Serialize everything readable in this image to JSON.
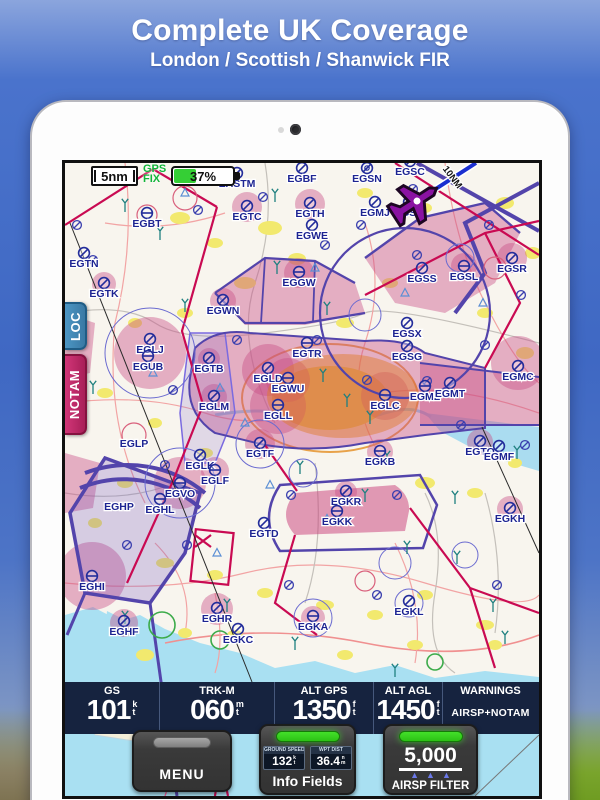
{
  "banner": {
    "title": "Complete UK Coverage",
    "subtitle": "London / Scottish / Shanwick FIR"
  },
  "hud": {
    "scale_label": "5nm",
    "gps_fix_line1": "GPS",
    "gps_fix_line2": "FIX",
    "battery_percent": 37,
    "battery_label": "37%",
    "track_distance_label": "10NM"
  },
  "side_tabs": {
    "loc": "LOC",
    "notam": "NOTAM"
  },
  "info_bar": {
    "cells": [
      {
        "label": "GS",
        "value": "101",
        "unit": [
          "k",
          "t"
        ]
      },
      {
        "label": "TRK-M",
        "value": "060",
        "unit": [
          "m",
          "t"
        ]
      },
      {
        "label": "ALT GPS",
        "value": "1350",
        "unit": [
          "f",
          "t"
        ]
      },
      {
        "label": "ALT AGL",
        "value": "1450",
        "unit": [
          "f",
          "t"
        ]
      },
      {
        "label": "WARNINGS",
        "value": "AIRSP+NOTAM"
      }
    ]
  },
  "bottom_buttons": {
    "menu_label": "MENU",
    "info_fields_label": "Info Fields",
    "mini_displays": [
      {
        "label": "GROUND SPEED",
        "value": "132",
        "unit": [
          "k",
          "t"
        ]
      },
      {
        "label": "WPT DIST",
        "value": "36.4",
        "unit": [
          "n",
          "m"
        ]
      }
    ],
    "airspace_filter_value": "5,000",
    "airspace_filter_label": "AIRSP FILTER"
  },
  "colors": {
    "accent_green": "#35cf35",
    "notam_pink": "#c42e6b",
    "loc_blue": "#4486b0",
    "infobar_navy": "#16233f",
    "aircraft_purple": "#8a12a2"
  },
  "map": {
    "airports": [
      {
        "id": "EASTM",
        "x": 172,
        "y": 24,
        "t": "s"
      },
      {
        "id": "EGBF",
        "x": 237,
        "y": 19,
        "t": "s"
      },
      {
        "id": "EGSN",
        "x": 302,
        "y": 19,
        "t": "d"
      },
      {
        "id": "EGSC",
        "x": 345,
        "y": 12,
        "t": "s"
      },
      {
        "id": "EGMJ",
        "x": 310,
        "y": 53,
        "t": "s"
      },
      {
        "id": "EGSU",
        "x": 344,
        "y": 53,
        "t": "s"
      },
      {
        "id": "EGBT",
        "x": 82,
        "y": 64,
        "t": "b"
      },
      {
        "id": "EGTC",
        "x": 182,
        "y": 57,
        "t": "s"
      },
      {
        "id": "EGTH",
        "x": 245,
        "y": 54,
        "t": "s"
      },
      {
        "id": "EGWE",
        "x": 247,
        "y": 76,
        "t": "s"
      },
      {
        "id": "EGTN",
        "x": 19,
        "y": 104,
        "t": "s"
      },
      {
        "id": "EGGW",
        "x": 234,
        "y": 123,
        "t": "b"
      },
      {
        "id": "EGSS",
        "x": 357,
        "y": 119,
        "t": "s"
      },
      {
        "id": "EGSL",
        "x": 399,
        "y": 117,
        "t": "b"
      },
      {
        "id": "EGSR",
        "x": 447,
        "y": 109,
        "t": "s"
      },
      {
        "id": "EGTK",
        "x": 39,
        "y": 134,
        "t": "s"
      },
      {
        "id": "EGWN",
        "x": 158,
        "y": 151,
        "t": "s"
      },
      {
        "id": "EGSX",
        "x": 342,
        "y": 174,
        "t": "s"
      },
      {
        "id": "EGSG",
        "x": 342,
        "y": 197,
        "t": "s"
      },
      {
        "id": "EGLJ",
        "x": 85,
        "y": 190,
        "t": "s"
      },
      {
        "id": "EGUB",
        "x": 83,
        "y": 207,
        "t": "b"
      },
      {
        "id": "EGTB",
        "x": 144,
        "y": 209,
        "t": "s"
      },
      {
        "id": "EGTR",
        "x": 242,
        "y": 194,
        "t": "b"
      },
      {
        "id": "EGLD",
        "x": 203,
        "y": 219,
        "t": "s"
      },
      {
        "id": "EGWU",
        "x": 223,
        "y": 229,
        "t": "b"
      },
      {
        "id": "EGMC",
        "x": 453,
        "y": 217,
        "t": "s"
      },
      {
        "id": "EGML",
        "x": 360,
        "y": 237,
        "t": "b"
      },
      {
        "id": "EGMT",
        "x": 385,
        "y": 234,
        "t": "s"
      },
      {
        "id": "EGLC",
        "x": 320,
        "y": 246,
        "t": "b"
      },
      {
        "id": "EGLM",
        "x": 149,
        "y": 247,
        "t": "s"
      },
      {
        "id": "EGLL",
        "x": 213,
        "y": 256,
        "t": "b"
      },
      {
        "id": "EGLP",
        "x": 69,
        "y": 284,
        "t": "n"
      },
      {
        "id": "EGTF",
        "x": 195,
        "y": 294,
        "t": "s"
      },
      {
        "id": "EGLK",
        "x": 135,
        "y": 306,
        "t": "s"
      },
      {
        "id": "EGLF",
        "x": 150,
        "y": 321,
        "t": "b"
      },
      {
        "id": "EGKB",
        "x": 315,
        "y": 302,
        "t": "b"
      },
      {
        "id": "EGTO",
        "x": 415,
        "y": 292,
        "t": "s"
      },
      {
        "id": "EGMF",
        "x": 434,
        "y": 297,
        "t": "s"
      },
      {
        "id": "EGVO",
        "x": 115,
        "y": 334,
        "t": "b"
      },
      {
        "id": "EGHP",
        "x": 54,
        "y": 347,
        "t": "n"
      },
      {
        "id": "EGHL",
        "x": 95,
        "y": 350,
        "t": "b"
      },
      {
        "id": "EGKR",
        "x": 281,
        "y": 342,
        "t": "s"
      },
      {
        "id": "EGKK",
        "x": 272,
        "y": 362,
        "t": "b"
      },
      {
        "id": "EGKH",
        "x": 445,
        "y": 359,
        "t": "s"
      },
      {
        "id": "EGTD",
        "x": 199,
        "y": 374,
        "t": "s"
      },
      {
        "id": "EGHI",
        "x": 27,
        "y": 427,
        "t": "b"
      },
      {
        "id": "EGHR",
        "x": 152,
        "y": 459,
        "t": "s"
      },
      {
        "id": "EGKL",
        "x": 344,
        "y": 452,
        "t": "s"
      },
      {
        "id": "EGKA",
        "x": 248,
        "y": 467,
        "t": "b"
      },
      {
        "id": "EGHF",
        "x": 59,
        "y": 472,
        "t": "s"
      },
      {
        "id": "EGKC",
        "x": 173,
        "y": 480,
        "t": "s"
      }
    ],
    "minor_symbols": [
      [
        12,
        62
      ],
      [
        28,
        97
      ],
      [
        133,
        47
      ],
      [
        198,
        34
      ],
      [
        260,
        82
      ],
      [
        296,
        62
      ],
      [
        352,
        92
      ],
      [
        424,
        62
      ],
      [
        456,
        132
      ],
      [
        420,
        182
      ],
      [
        108,
        227
      ],
      [
        172,
        177
      ],
      [
        252,
        177
      ],
      [
        302,
        217
      ],
      [
        362,
        218
      ],
      [
        396,
        262
      ],
      [
        100,
        302
      ],
      [
        226,
        332
      ],
      [
        332,
        332
      ],
      [
        224,
        422
      ],
      [
        312,
        432
      ],
      [
        432,
        422
      ],
      [
        62,
        382
      ],
      [
        122,
        382
      ],
      [
        460,
        282
      ],
      [
        348,
        26
      ]
    ]
  }
}
